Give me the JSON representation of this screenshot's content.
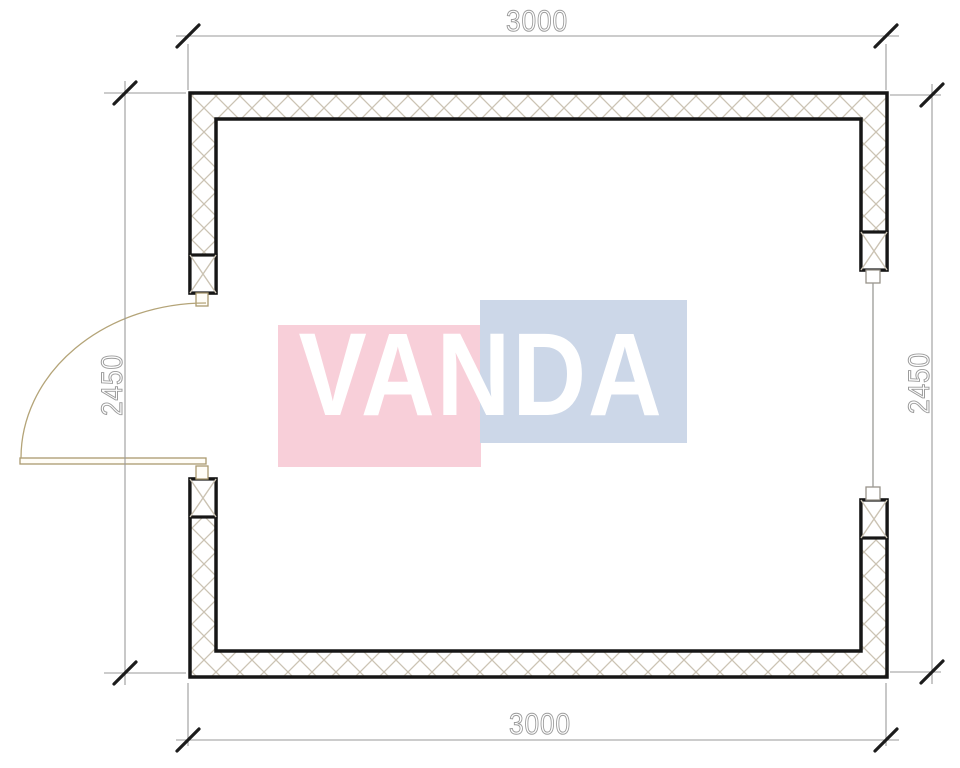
{
  "page": {
    "background": "#ffffff"
  },
  "watermark": {
    "text": "VANDA",
    "pink_color": "#f8cfd9",
    "blue_color": "#ccd7e8",
    "text_color": "#ffffff"
  },
  "dimensions": {
    "top": "3000",
    "bottom": "3000",
    "left": "2450",
    "right": "2450"
  },
  "drawing": {
    "colors": {
      "wall_outline": "#161616",
      "wall_hatch": "#cbc3b3",
      "dimension_line": "#9a9a9a",
      "dimension_tick": "#1c1c1c",
      "dimension_text_outline": "#9c9c9c",
      "door": "#ab9a70",
      "window": "#9a9a96"
    }
  }
}
